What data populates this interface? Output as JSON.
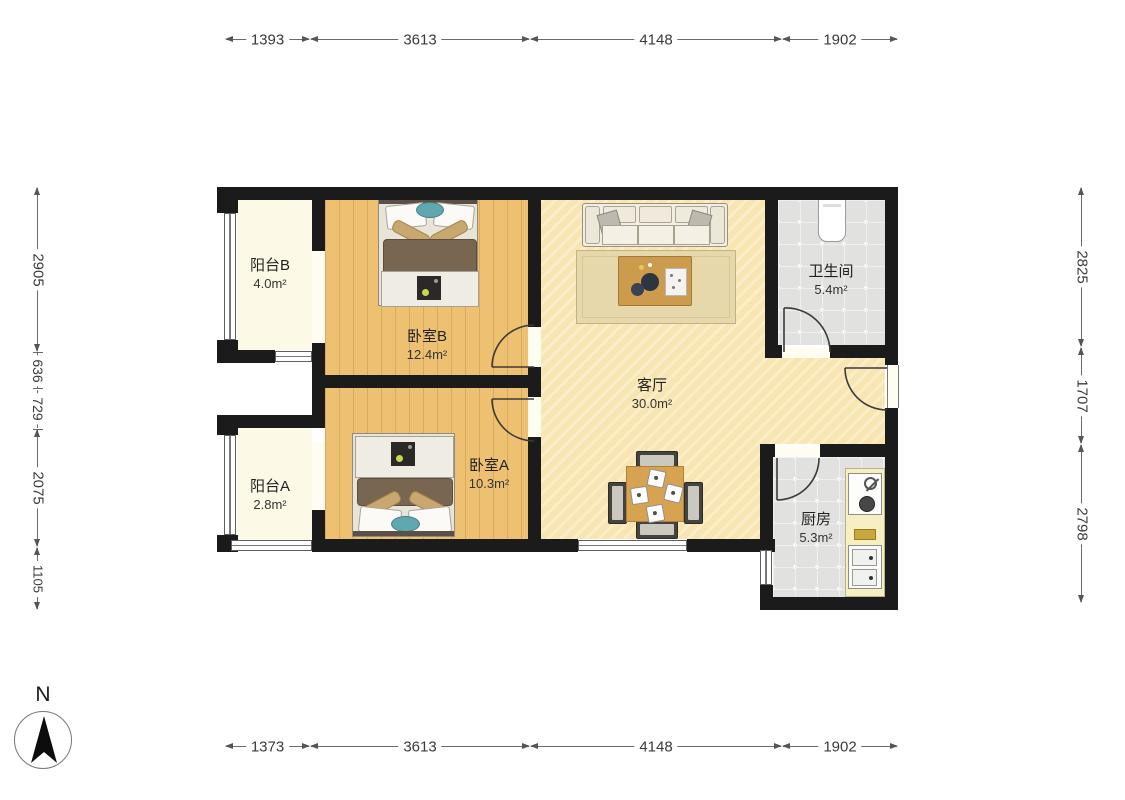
{
  "compass": {
    "label": "N"
  },
  "dimensions": {
    "top": [
      "1393",
      "3613",
      "4148",
      "1902"
    ],
    "bottom": [
      "1373",
      "3613",
      "4148",
      "1902"
    ],
    "left": [
      "2905",
      "636",
      "729",
      "2075",
      "1105"
    ],
    "right": [
      "2825",
      "1707",
      "2798"
    ]
  },
  "rooms": {
    "balcony_b": {
      "name": "阳台B",
      "area": "4.0m²"
    },
    "bedroom_b": {
      "name": "卧室B",
      "area": "12.4m²"
    },
    "living": {
      "name": "客厅",
      "area": "30.0m²"
    },
    "bathroom": {
      "name": "卫生间",
      "area": "5.4m²"
    },
    "balcony_a": {
      "name": "阳台A",
      "area": "2.8m²"
    },
    "bedroom_a": {
      "name": "卧室A",
      "area": "10.3m²"
    },
    "kitchen": {
      "name": "厨房",
      "area": "5.3m²"
    }
  },
  "colors": {
    "wall": "#1b1b1b",
    "wood_floor": "#eec172",
    "living_floor": "#f8e6b2",
    "balcony_floor": "#fcfae6",
    "tile_floor": "#e1e1df",
    "dimension_text": "#3a3a3a",
    "label_text": "#222222",
    "accent_teal": "#5fa8b0",
    "wood_furniture": "#d8a351"
  }
}
